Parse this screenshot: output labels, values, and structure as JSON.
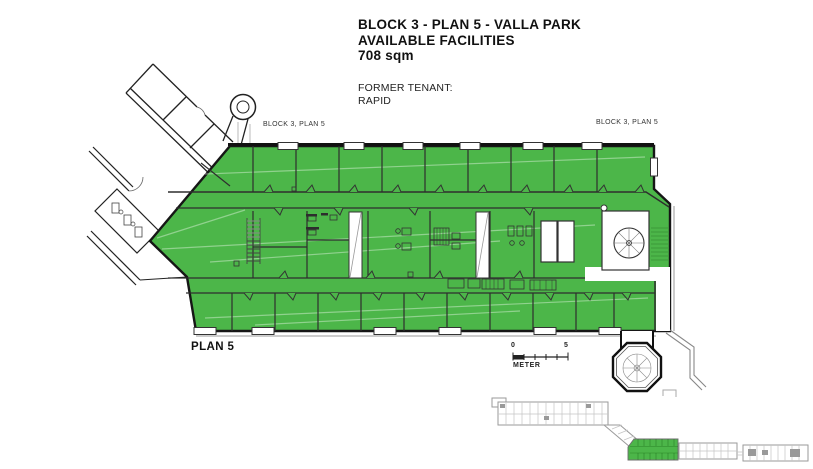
{
  "header": {
    "title_line1": "BLOCK 3 - PLAN 5 - VALLA PARK",
    "title_line2": "AVAILABLE FACILITIES",
    "title_line3": "708 sqm",
    "former_tenant_label": "FORMER TENANT:",
    "former_tenant_name": "RAPID"
  },
  "plan": {
    "wing_label_left": "BLOCK 3, PLAN 5",
    "wing_label_right": "BLOCK 3, PLAN 5",
    "plan_name": "PLAN 5"
  },
  "scale_bar": {
    "min_label": "0",
    "max_label": "5",
    "unit_label": "METER"
  },
  "colors": {
    "available_green": "#4cb649",
    "wall_dark": "#1a1a1a",
    "minimap_gray": "#9a9a9a"
  }
}
